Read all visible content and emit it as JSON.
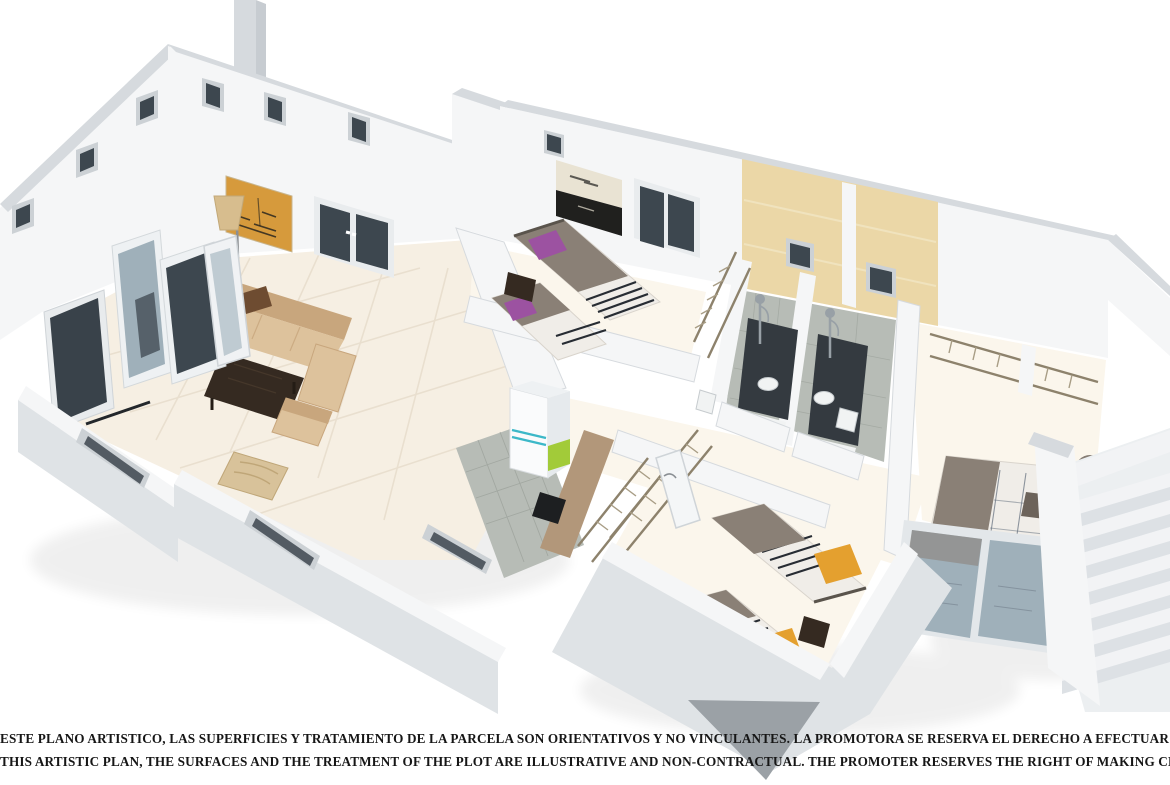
{
  "image": {
    "kind": "3d-floor-plan-render",
    "width": 1170,
    "height": 785
  },
  "disclaimer": {
    "line1_es": "ESTE PLANO ARTISTICO, LAS SUPERFICIES Y TRATAMIENTO DE LA PARCELA SON ORIENTATIVOS Y NO VINCULANTES. LA PROMOTORA SE RESERVA EL DERECHO A EFECTUAR MODIFICACIONES POR CUALQUIER NECESIDAD",
    "line2_en": "THIS ARTISTIC PLAN, THE SURFACES AND THE TREATMENT OF THE PLOT ARE ILLUSTRATIVE AND NON-CONTRACTUAL. THE PROMOTER RESERVES THE RIGHT OF MAKING CHANGES DUE TO ANY NECESSITY"
  },
  "scene": {
    "areas": [
      "living-room",
      "kitchen",
      "hallway",
      "bedroom-1",
      "bathroom-1",
      "bathroom-2",
      "bedroom-2",
      "master-bedroom",
      "stairs"
    ],
    "furniture": [
      "corner-sofa",
      "coffee-table",
      "armchair",
      "rattan-chair",
      "floor-lamp",
      "wall-art-orange",
      "wall-art-bw",
      "sliding-glass-door",
      "entrance-door",
      "fridge",
      "kitchen-counter",
      "cooktop",
      "single-bed",
      "double-bed",
      "nightstand",
      "wardrobe-rails",
      "shower-column",
      "toilet",
      "washbasin",
      "glass-window-wall",
      "staircase"
    ]
  },
  "palette": {
    "bg": "#ffffff",
    "wall": "#f5f6f7",
    "wall2": "#eceef0",
    "wallTop": "#d6dade",
    "wallSide": "#c7ccd1",
    "wallGray": "#dfe3e6",
    "floor": "#f6efe3",
    "floorLight": "#fbf6ec",
    "tile": "#e7ddcc",
    "grayTile": "#b7bcb6",
    "grayTileLine": "#9da39c",
    "wood": "#b2977a",
    "glass": "#3d474f",
    "glassLight": "#9fb0ba",
    "frame": "#ccd1d5",
    "sofa": "#ddc29c",
    "sofaShade": "#c8a67d",
    "cushion": "#6e4c31",
    "table": "#352a21",
    "lamp": "#d7bd8e",
    "artOrange": "#d69a3c",
    "artInk": "#20201e",
    "artCream": "#e9e3d3",
    "duvet": "#8a8076",
    "duvetDark": "#6c635a",
    "mattress": "#f0ede8",
    "pillowPurple": "#9c52a1",
    "pillowYellow": "#e4a02f",
    "stripe": "#272c33",
    "bath": "#ebd7a7",
    "shower": "#343a40",
    "chrome": "#98a0a6",
    "fixture": "#f1f3f3",
    "railWood": "#8d826c",
    "green": "#a2cb39",
    "cyan": "#3cb8c8",
    "stair": "#f2f3f5",
    "stairShade": "#dde1e5",
    "tip": "#9ba1a6",
    "text": "#161616"
  }
}
